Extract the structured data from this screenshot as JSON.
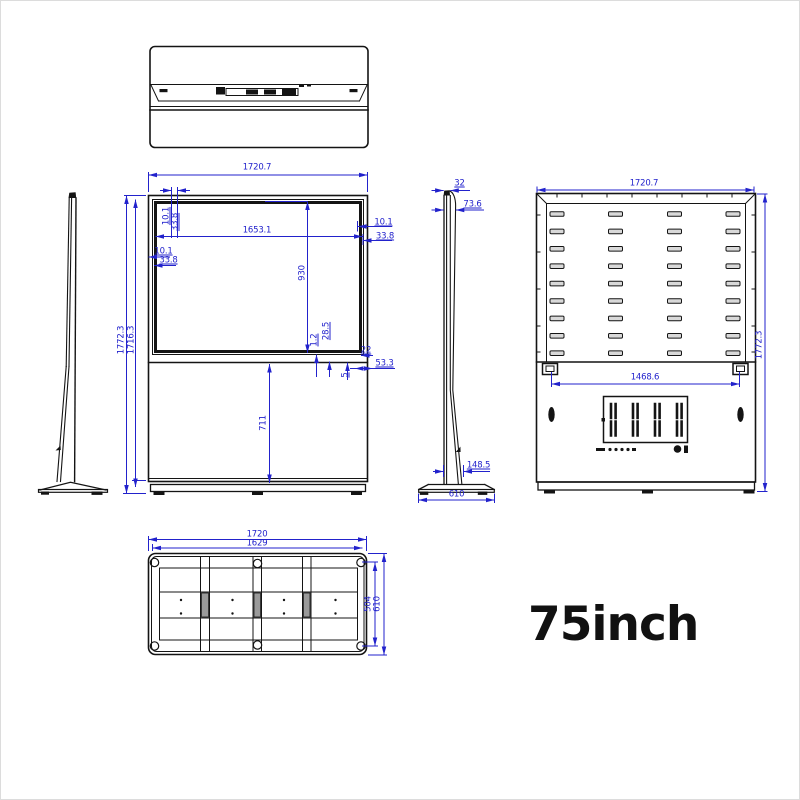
{
  "title": "75inch",
  "colors": {
    "dimension": "#2222cc",
    "linework": "#141414",
    "background": "#ffffff"
  },
  "dims": {
    "front": {
      "overall_width": "1720.7",
      "overall_height": "1772.3",
      "body_height": "1716.3",
      "screen_width": "1653.1",
      "screen_height": "930",
      "lower_panel_height": "711",
      "top_offset_small": "10.1",
      "top_offset_large": "33.8",
      "right_offset_small": "10.1",
      "right_offset_large": "33.8",
      "left_offset_small": "10.1",
      "left_offset_large": "33.8",
      "seam_gap": "1.2",
      "seam_offset": "28.5",
      "corner_offset_a": "22",
      "corner_offset_b": "53.3",
      "corner_offset_c": "5"
    },
    "side": {
      "panel_thickness": "32",
      "head_depth": "73.6",
      "column_depth": "148.5",
      "base_depth": "610"
    },
    "back": {
      "overall_width": "1720.7",
      "overall_height": "1772.3",
      "bracket_span": "1468.6"
    },
    "bottom": {
      "overall_width": "1720",
      "inner_width": "1629",
      "plate_depth": "504",
      "overall_depth": "610"
    }
  }
}
